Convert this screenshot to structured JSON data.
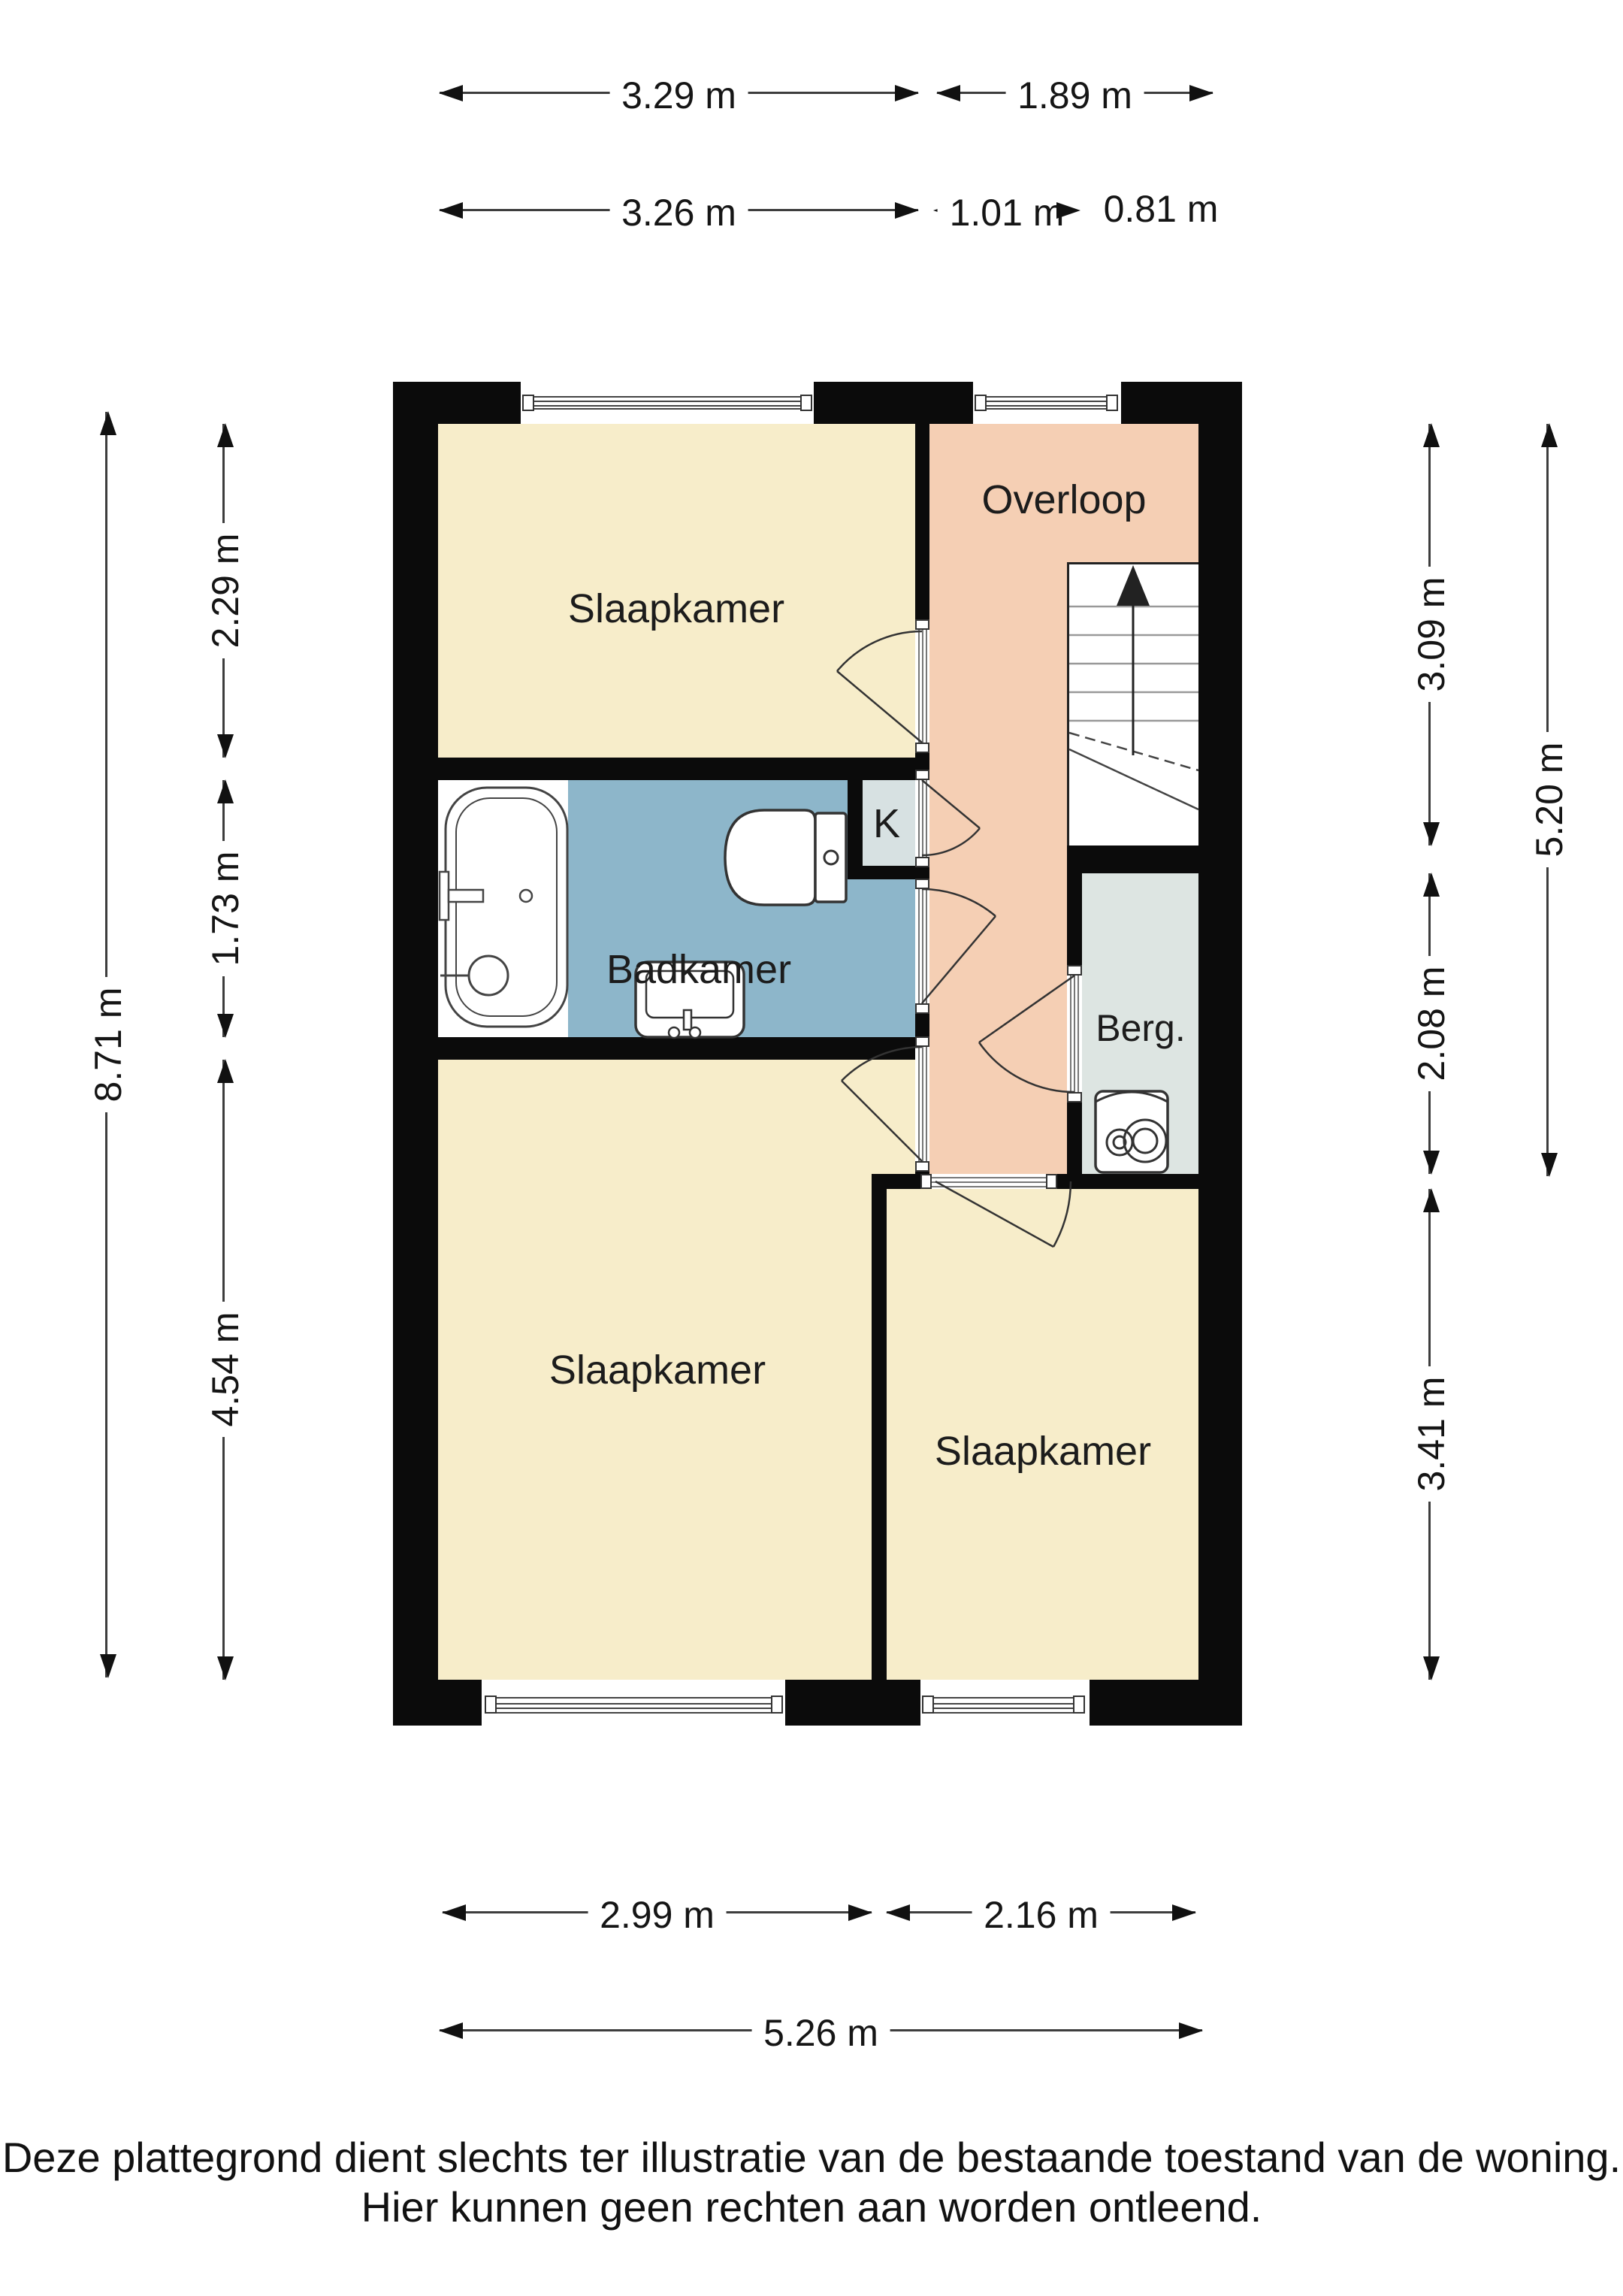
{
  "rooms": {
    "bedroom_top": "Slaapkamer",
    "bathroom": "Badkamer",
    "closet": "K",
    "landing": "Overloop",
    "storage": "Berg.",
    "bedroom_large": "Slaapkamer",
    "bedroom_right": "Slaapkamer"
  },
  "dimensions": {
    "top_row1": [
      {
        "label": "3.29 m"
      },
      {
        "label": "1.89 m"
      }
    ],
    "top_row2": [
      {
        "label": "3.26 m"
      },
      {
        "label": "1.01 m"
      },
      {
        "label": "0.81 m"
      }
    ],
    "left_outer": {
      "label": "8.71 m"
    },
    "left_inner": [
      {
        "label": "2.29 m"
      },
      {
        "label": "1.73 m"
      },
      {
        "label": "4.54 m"
      }
    ],
    "right_inner": [
      {
        "label": "3.09 m"
      },
      {
        "label": "2.08 m"
      },
      {
        "label": "3.41 m"
      }
    ],
    "right_outer": {
      "label": "5.20 m"
    },
    "bottom_row1": [
      {
        "label": "2.99 m"
      },
      {
        "label": "2.16 m"
      }
    ],
    "bottom_row2": {
      "label": "5.26 m"
    }
  },
  "disclaimer": {
    "line1": "Deze plattegrond dient slechts ter illustratie van de bestaande toestand van de woning.",
    "line2": "Hier kunnen geen rechten aan worden ontleend."
  },
  "colors": {
    "room_cream": "#f7edca",
    "landing_salmon": "#f5cfb4",
    "bathroom_blue": "#8db6ca",
    "storage_gray": "#dde5e2",
    "closet_gray": "#d7e1e2",
    "wall_black": "#0b0b0b"
  }
}
